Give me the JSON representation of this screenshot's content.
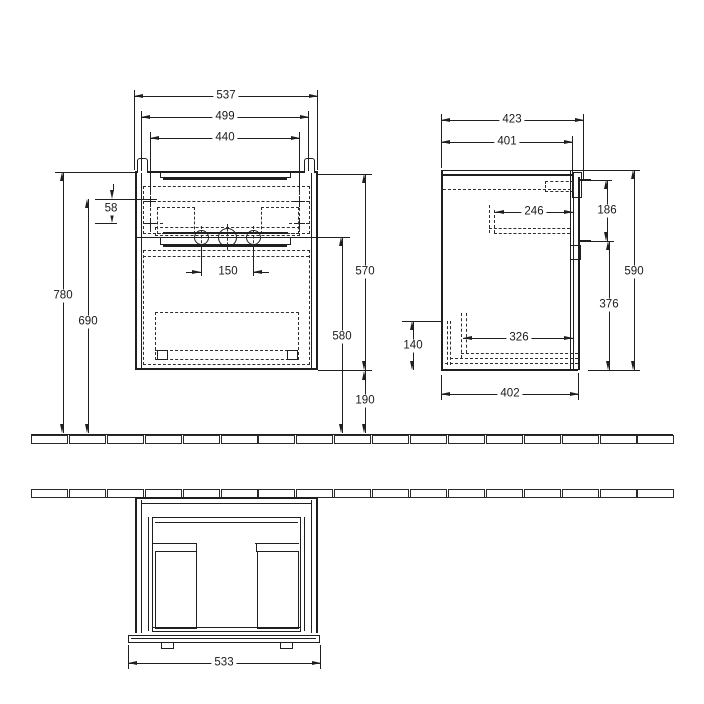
{
  "meta": {
    "background_color": "#ffffff",
    "line_color": "#1f1f1f",
    "description": "Dimensioned technical drawing of a wall-mounted vanity unit: front view, side view and bottom view with wall/floor hatch lines. All dimensions in mm."
  },
  "views": {
    "front": {
      "overall_width": "537",
      "carcass_width": "499",
      "fixing_width": "440",
      "fixing_row_gap": "58",
      "tap_hole_spacing": "150",
      "total_height": "780",
      "fixing_height": "690",
      "carcass_height": "570",
      "front_height": "580",
      "floor_clearance": "190"
    },
    "side": {
      "overall_depth": "423",
      "carcass_depth": "401",
      "bracket_depth": "246",
      "bracket_drop": "186",
      "height": "590",
      "lower_height": "376",
      "recess_height": "140",
      "inner_depth": "326",
      "bottom_depth": "402"
    },
    "bottom": {
      "front_width": "533"
    }
  }
}
